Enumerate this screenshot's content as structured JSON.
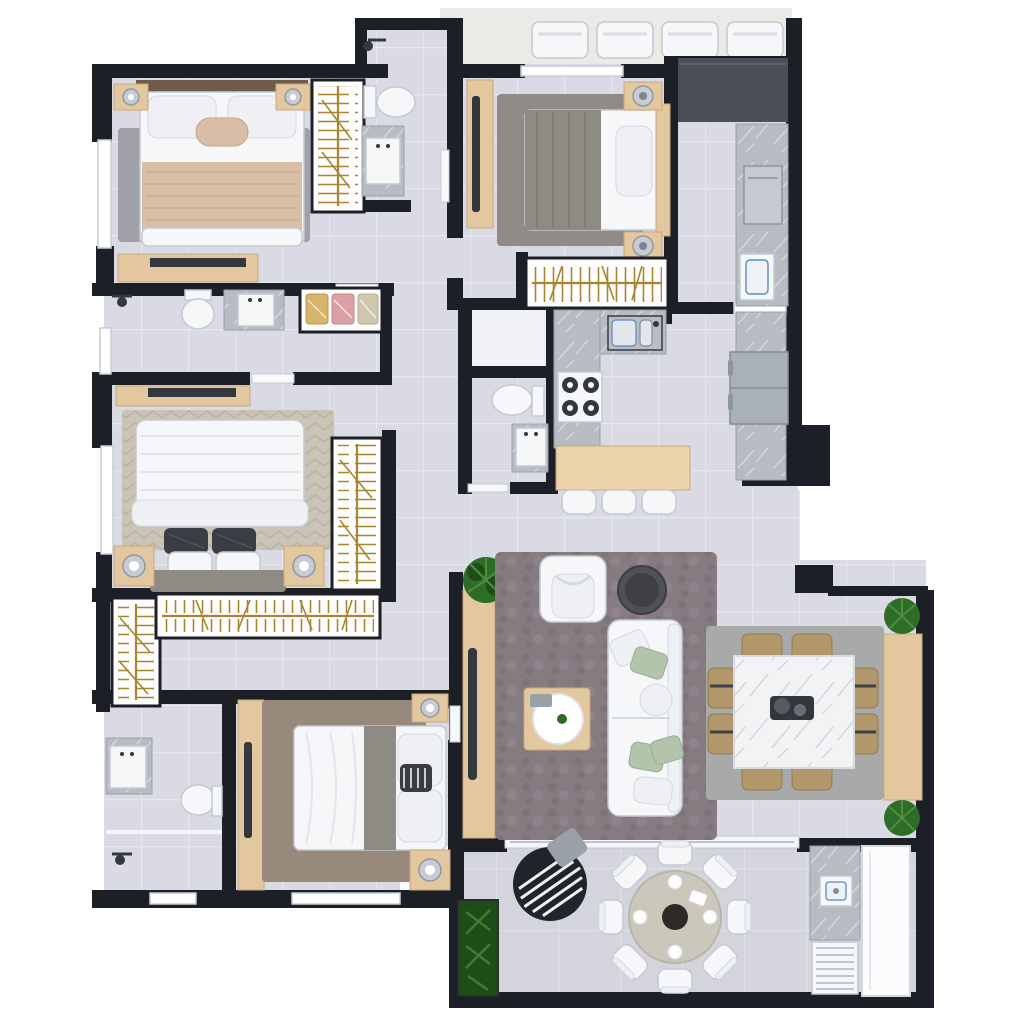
{
  "image_type": "3d-floor-plan-render",
  "palette": {
    "pageBg": "#ffffff",
    "wall": "#1c2026",
    "floor": "#d9dae3",
    "grout": "#e7e8ef",
    "balconyFloor": "#d3d4dc",
    "balconyGrout": "#dfe0e7",
    "exterior": "#ebeae7",
    "marble": "#b7bbc2",
    "marbleVein": "#d8dbe0",
    "marbleWhite": "#f2f3f5",
    "marbleWhiteVein": "#cdd0d6",
    "darkCounter": "#4b4f57",
    "wood": "#e2c79f",
    "woodShade": "#c9a97c",
    "gold": "#a8862f",
    "white": "#f6f7f9",
    "softWhite": "#eef0f4",
    "silver": "#c7cbd2",
    "dark": "#34373d",
    "fridge": "#aab0ba",
    "washer": "#c6cad0",
    "plant": "#2e6d27",
    "plantDark": "#1e4e18",
    "rugGray": "#9fa0a8",
    "rugTaupe": "#867b81",
    "rugBeige": "#cac4b6",
    "rugBrown": "#97897b",
    "rugDining": "#a7aaa9",
    "rugSuite2": "#918b88",
    "blanketBeige": "#d8bea6",
    "blanketGray": "#8e8b85",
    "pillowDark": "#3a3d43",
    "pillowGreen": "#b3c4ad",
    "chairTan": "#b2976a",
    "eggChair": "#21242a",
    "tableRound": "#cbc7bb",
    "clothesYellow": "#d9b36a",
    "clothesPink": "#dba0a4",
    "clothesBeige": "#cfc7ae",
    "blue": "#5b89c4"
  },
  "floorplan": {
    "rooms": [
      {
        "id": "bedroom-top-left",
        "label": "bedroom",
        "furniture": [
          "double-bed",
          "headboard",
          "two-nightstands-with-lamps",
          "gray-area-rug",
          "dresser",
          "hanging-rail-closet"
        ]
      },
      {
        "id": "bathroom-top",
        "label": "bathroom",
        "furniture": [
          "shower",
          "toilet",
          "marble-vanity-sink"
        ]
      },
      {
        "id": "bedroom-top-right",
        "label": "bedroom",
        "furniture": [
          "double-bed",
          "two-nightstands-with-lamps",
          "area-rug",
          "tv-console",
          "hanging-rail-closet"
        ]
      },
      {
        "id": "service-area",
        "label": "laundry-service",
        "furniture": [
          "dark-countertop",
          "washing-machine",
          "laundry-sink",
          "marble-counter"
        ]
      },
      {
        "id": "kitchen",
        "label": "kitchen",
        "furniture": [
          "l-shaped-marble-counter",
          "double-sink",
          "four-burner-cooktop",
          "wood-island-bench",
          "three-stools",
          "refrigerator",
          "side-counter"
        ]
      },
      {
        "id": "powder-room",
        "label": "powder-room",
        "furniture": [
          "toilet",
          "sink",
          "storage-closet"
        ]
      },
      {
        "id": "bathroom-mid-left",
        "label": "bathroom",
        "furniture": [
          "shower",
          "toilet",
          "marble-vanity-sink",
          "shelf-with-folded-clothes"
        ]
      },
      {
        "id": "master-bedroom",
        "label": "bedroom",
        "furniture": [
          "double-bed",
          "two-nightstands-with-lamps",
          "patterned-rug",
          "dresser",
          "hanging-rail-closet"
        ]
      },
      {
        "id": "walk-in-closet",
        "label": "walk-in-closet",
        "furniture": [
          "l-shaped-hanging-rails"
        ]
      },
      {
        "id": "bathroom-bottom-left",
        "label": "bathroom",
        "furniture": [
          "marble-vanity-sink",
          "toilet",
          "shower",
          "glass-partition"
        ]
      },
      {
        "id": "bedroom-bottom",
        "label": "bedroom",
        "furniture": [
          "double-bed",
          "two-nightstands-with-lamps",
          "brown-area-rug",
          "wardrobe",
          "tv-panel"
        ]
      },
      {
        "id": "living-room",
        "label": "living-room",
        "furniture": [
          "sofa-with-pillows",
          "armchair",
          "wood-coffee-table-with-tray",
          "round-side-table",
          "tv-sideboard",
          "plant",
          "shag-rug"
        ]
      },
      {
        "id": "dining-room",
        "label": "dining-room",
        "furniture": [
          "square-marble-table",
          "eight-tan-chairs",
          "sideboard",
          "two-plants",
          "area-rug",
          "centerpiece"
        ]
      },
      {
        "id": "balcony",
        "label": "balcony-terrace",
        "furniture": [
          "round-table",
          "eight-chairs",
          "hanging-egg-chair",
          "planter",
          "bbq-marble-counter",
          "grill",
          "vent-panel",
          "glass-panel"
        ]
      },
      {
        "id": "upper-terrace",
        "label": "upper-terrace",
        "furniture": [
          "four-white-loungers"
        ]
      }
    ]
  }
}
